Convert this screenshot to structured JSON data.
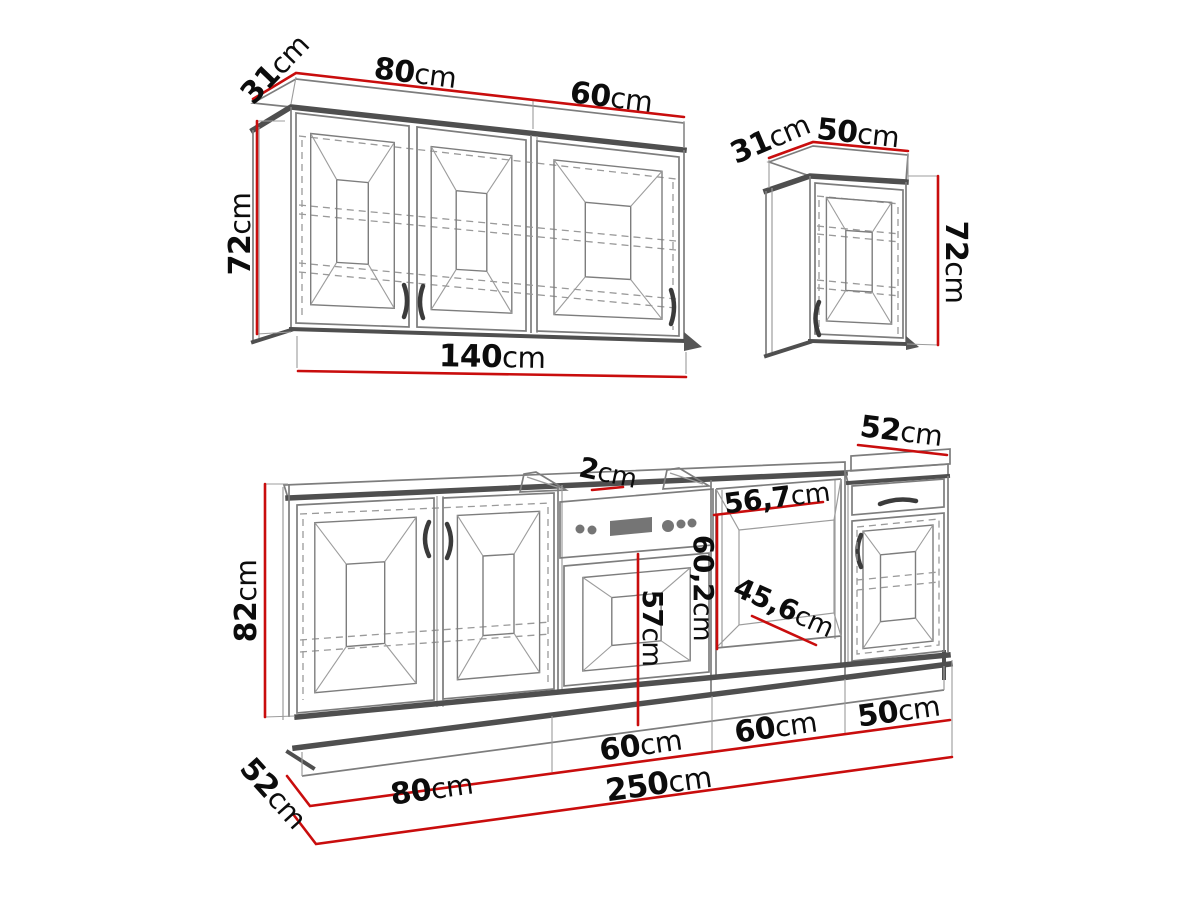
{
  "dims": {
    "wall_unit_triple": {
      "depth": {
        "v": "31",
        "u": "cm"
      },
      "left_width": {
        "v": "80",
        "u": "cm"
      },
      "right_width": {
        "v": "60",
        "u": "cm"
      },
      "height": {
        "v": "72",
        "u": "cm"
      },
      "total_width": {
        "v": "140",
        "u": "cm"
      }
    },
    "wall_unit_single": {
      "depth": {
        "v": "31",
        "u": "cm"
      },
      "width": {
        "v": "50",
        "u": "cm"
      },
      "height": {
        "v": "72",
        "u": "cm"
      }
    },
    "base_run": {
      "height": {
        "v": "82",
        "u": "cm"
      },
      "left_depth": {
        "v": "52",
        "u": "cm"
      },
      "worktop_thickness": {
        "v": "2",
        "u": "cm"
      },
      "oven_niche_width": {
        "v": "56,7",
        "u": "cm"
      },
      "oven_door_height": {
        "v": "57",
        "u": "cm"
      },
      "niche_height": {
        "v": "60,2",
        "u": "cm"
      },
      "niche_diagonal": {
        "v": "45,6",
        "u": "cm"
      },
      "right_unit_depth": {
        "v": "52",
        "u": "cm"
      },
      "sections": [
        {
          "v": "80",
          "u": "cm"
        },
        {
          "v": "60",
          "u": "cm"
        },
        {
          "v": "60",
          "u": "cm"
        },
        {
          "v": "50",
          "u": "cm"
        }
      ],
      "total_width": {
        "v": "250",
        "u": "cm"
      }
    }
  },
  "colors": {
    "dimension_red": "#c90d0d",
    "line_dark": "#4f4f4f",
    "line_mid": "#7d7d7d",
    "line_light": "#9c9c9c",
    "dashed": "#9a9a9a",
    "appliance_gray": "#757575",
    "text": "#0c0c0c",
    "background": "#ffffff"
  }
}
